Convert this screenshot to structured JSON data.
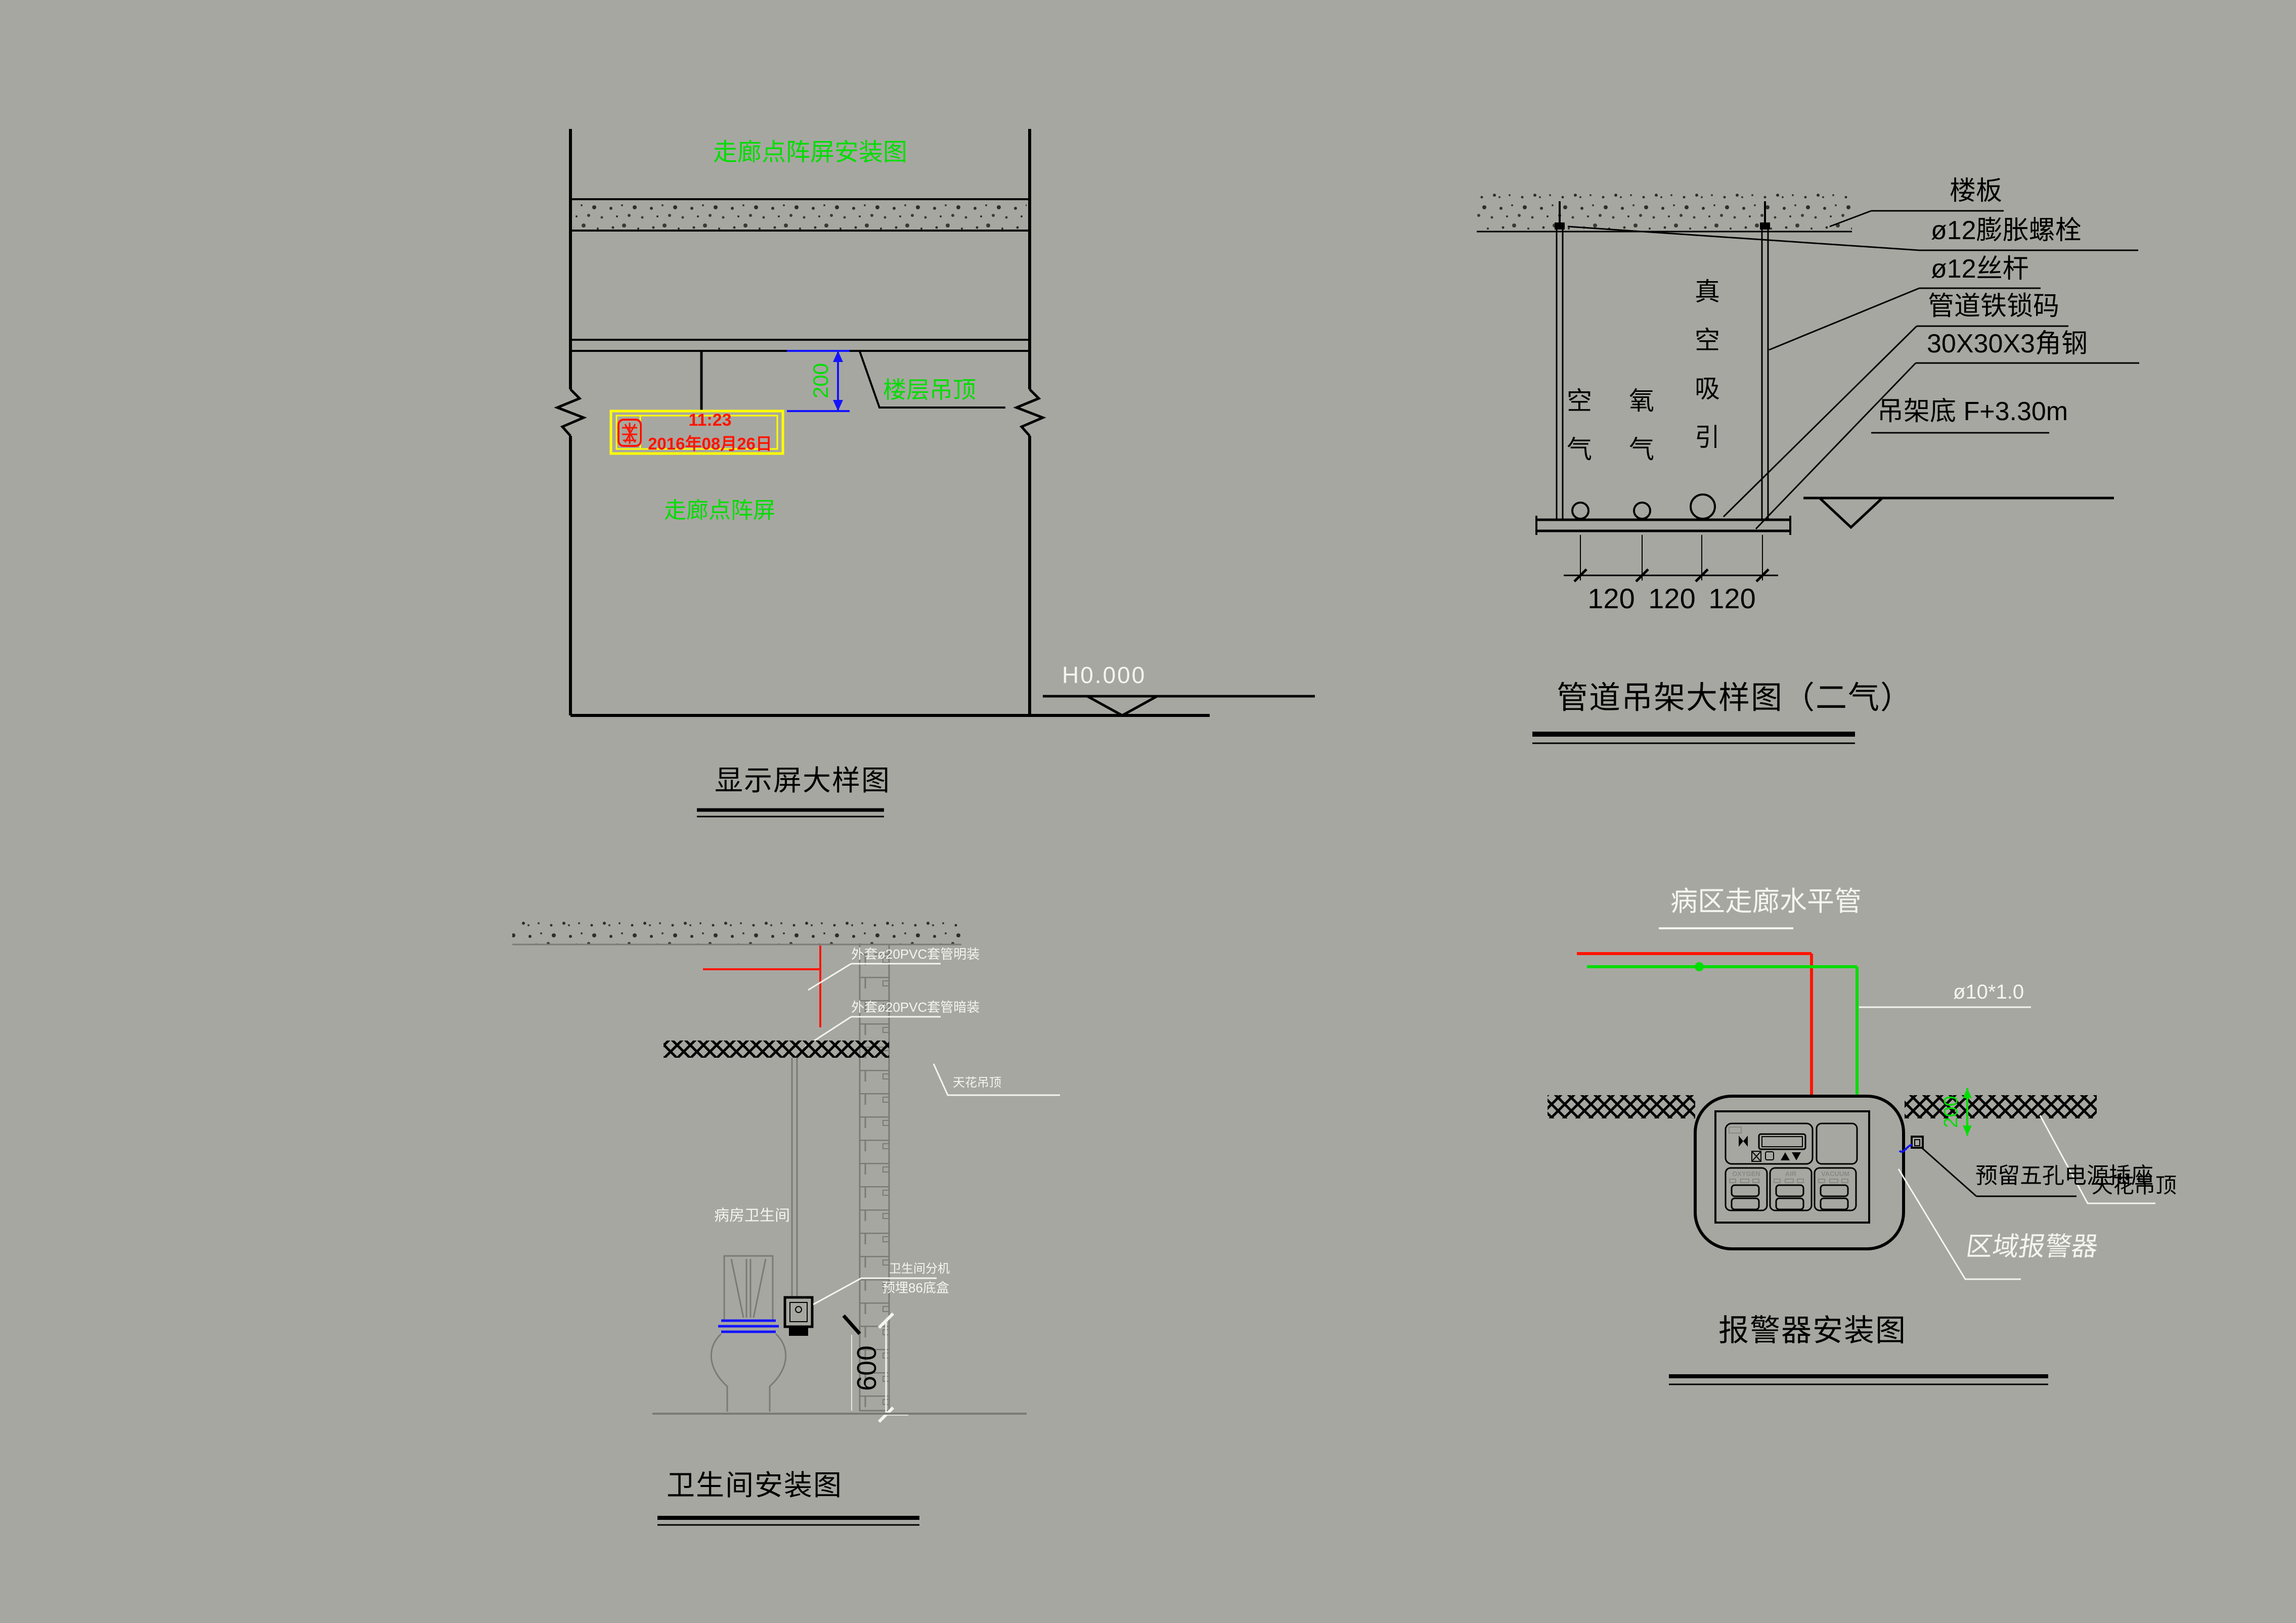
{
  "colors": {
    "background": "#a7a7a1",
    "line_black": "#000000",
    "accent_green": "#00dd00",
    "accent_red": "#ff1400",
    "accent_yellow": "#ffff00",
    "accent_blue": "#1414ff",
    "annotation_white": "#f5f5f0",
    "drawing_gray": "#7b7b76"
  },
  "display_detail": {
    "title": "走廊点阵屏安装图",
    "ceiling_label": "楼层吊顶",
    "dim_top": "200",
    "screen_time": "11:23",
    "screen_date": "2016年08月26日",
    "screen_label": "走廊点阵屏",
    "floor_level": "H0.000",
    "caption": "显示屏大样图"
  },
  "hanger_detail": {
    "labels": [
      "楼板",
      "ø12膨胀螺栓",
      "ø12丝杆",
      "管道铁锁码",
      "30X30X3角钢"
    ],
    "datum_label": "吊架底 F+3.30m",
    "gas_left": "空气",
    "gas_mid": "氧气",
    "gas_right": "真空吸引",
    "dims": [
      "120",
      "120",
      "120"
    ],
    "caption": "管道吊架大样图（二气）"
  },
  "toilet_detail": {
    "pvc_surface": "外套ø20PVC套管明装",
    "pvc_concealed": "外套ø20PVC套管暗装",
    "ceiling_label": "天花吊顶",
    "room_label": "病房卫生间",
    "handset_line1": "卫生间分机",
    "handset_line2": "预埋86底盒",
    "dim_height": "600",
    "caption": "卫生间安装图"
  },
  "alarm_detail": {
    "pipe_label": "病区走廊水平管",
    "pipe_spec": "ø10*1.0",
    "socket_label": "预留五孔电源插座",
    "ceiling_label": "天花吊顶",
    "alarm_label": "区域报警器",
    "dim_drop": "200",
    "panel_sections": [
      "OXYGEN",
      "AIR",
      "VACUUM"
    ],
    "caption": "报警器安装图"
  }
}
